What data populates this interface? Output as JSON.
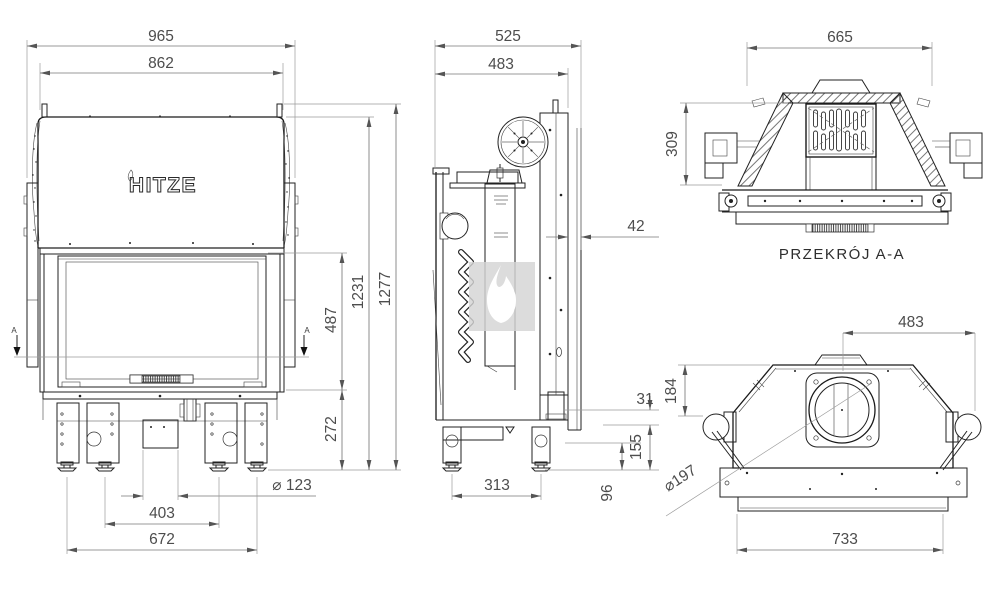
{
  "brand": {
    "logo_text": "HITZE"
  },
  "views": {
    "front": {
      "dims": {
        "overall_width": "965",
        "body_width": "862",
        "total_height": "1277",
        "body_height": "1231",
        "glass_height": "487",
        "base_height": "272",
        "intake_diameter": "⌀ 123",
        "feet_spacing_inner": "403",
        "feet_spacing_outer": "672"
      },
      "section_marker_left": "A",
      "section_marker_right": "A"
    },
    "side": {
      "dims": {
        "overall_depth": "525",
        "body_depth": "483",
        "rear_shield_gap": "42",
        "rear_pipe_offset": "31",
        "rear_clearance": "155",
        "intake_height": "96",
        "feet_spacing": "313"
      }
    },
    "section_aa": {
      "caption": "PRZEKRÓJ A-A",
      "dims": {
        "width": "665",
        "height": "309"
      }
    },
    "top": {
      "dims": {
        "flue_center_to_edge": "483",
        "flue_center_depth": "184",
        "flue_diameter": "⌀197",
        "base_width": "733"
      }
    }
  }
}
